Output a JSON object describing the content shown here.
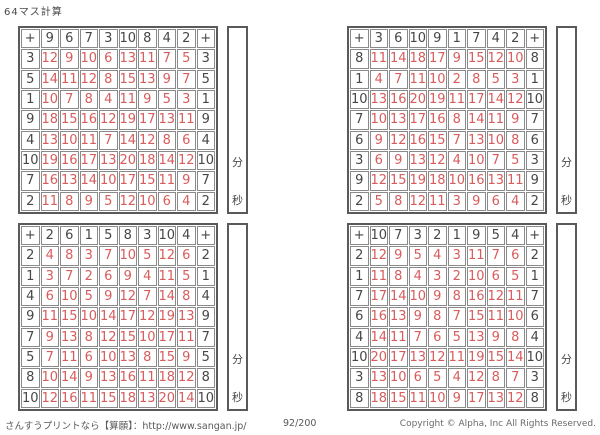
{
  "page": {
    "title": "64マス計算"
  },
  "labels": {
    "operator": "+",
    "minutes": "分",
    "seconds": "秒"
  },
  "colors": {
    "header_text": "#474747",
    "answer_text": "#d95c5c",
    "grid_line": "#8a8a8a",
    "grid_border": "#5a5a5a"
  },
  "grids": [
    {
      "position": "top-left",
      "top_headers": [
        9,
        6,
        7,
        3,
        10,
        8,
        4,
        2
      ],
      "rows": [
        {
          "header": 3,
          "answers": [
            12,
            9,
            10,
            6,
            13,
            11,
            7,
            5
          ]
        },
        {
          "header": 5,
          "answers": [
            14,
            11,
            12,
            8,
            15,
            13,
            9,
            7
          ]
        },
        {
          "header": 1,
          "answers": [
            10,
            7,
            8,
            4,
            11,
            9,
            5,
            3
          ]
        },
        {
          "header": 9,
          "answers": [
            18,
            15,
            16,
            12,
            19,
            17,
            13,
            11
          ]
        },
        {
          "header": 4,
          "answers": [
            13,
            10,
            11,
            7,
            14,
            12,
            8,
            6
          ]
        },
        {
          "header": 10,
          "answers": [
            19,
            16,
            17,
            13,
            20,
            18,
            14,
            12
          ]
        },
        {
          "header": 7,
          "answers": [
            16,
            13,
            14,
            10,
            17,
            15,
            11,
            9
          ]
        },
        {
          "header": 2,
          "answers": [
            11,
            8,
            9,
            5,
            12,
            10,
            6,
            4
          ]
        }
      ]
    },
    {
      "position": "top-right",
      "top_headers": [
        3,
        6,
        10,
        9,
        1,
        7,
        4,
        2
      ],
      "rows": [
        {
          "header": 8,
          "answers": [
            11,
            14,
            18,
            17,
            9,
            15,
            12,
            10
          ]
        },
        {
          "header": 1,
          "answers": [
            4,
            7,
            11,
            10,
            2,
            8,
            5,
            3
          ]
        },
        {
          "header": 10,
          "answers": [
            13,
            16,
            20,
            19,
            11,
            17,
            14,
            12
          ]
        },
        {
          "header": 7,
          "answers": [
            10,
            13,
            17,
            16,
            8,
            14,
            11,
            9
          ]
        },
        {
          "header": 6,
          "answers": [
            9,
            12,
            16,
            15,
            7,
            13,
            10,
            8
          ]
        },
        {
          "header": 3,
          "answers": [
            6,
            9,
            13,
            12,
            4,
            10,
            7,
            5
          ]
        },
        {
          "header": 9,
          "answers": [
            12,
            15,
            19,
            18,
            10,
            16,
            13,
            11
          ]
        },
        {
          "header": 2,
          "answers": [
            5,
            8,
            12,
            11,
            3,
            9,
            6,
            4
          ]
        }
      ]
    },
    {
      "position": "bottom-left",
      "top_headers": [
        2,
        6,
        1,
        5,
        8,
        3,
        10,
        4
      ],
      "rows": [
        {
          "header": 2,
          "answers": [
            4,
            8,
            3,
            7,
            10,
            5,
            12,
            6
          ]
        },
        {
          "header": 1,
          "answers": [
            3,
            7,
            2,
            6,
            9,
            4,
            11,
            5
          ]
        },
        {
          "header": 4,
          "answers": [
            6,
            10,
            5,
            9,
            12,
            7,
            14,
            8
          ]
        },
        {
          "header": 9,
          "answers": [
            11,
            15,
            10,
            14,
            17,
            12,
            19,
            13
          ]
        },
        {
          "header": 7,
          "answers": [
            9,
            13,
            8,
            12,
            15,
            10,
            17,
            11
          ]
        },
        {
          "header": 5,
          "answers": [
            7,
            11,
            6,
            10,
            13,
            8,
            15,
            9
          ]
        },
        {
          "header": 8,
          "answers": [
            10,
            14,
            9,
            13,
            16,
            11,
            18,
            12
          ]
        },
        {
          "header": 10,
          "answers": [
            12,
            16,
            11,
            15,
            18,
            13,
            20,
            14
          ]
        }
      ]
    },
    {
      "position": "bottom-right",
      "top_headers": [
        10,
        7,
        3,
        2,
        1,
        9,
        5,
        4
      ],
      "rows": [
        {
          "header": 2,
          "answers": [
            12,
            9,
            5,
            4,
            3,
            11,
            7,
            6
          ]
        },
        {
          "header": 1,
          "answers": [
            11,
            8,
            4,
            3,
            2,
            10,
            6,
            5
          ]
        },
        {
          "header": 7,
          "answers": [
            17,
            14,
            10,
            9,
            8,
            16,
            12,
            11
          ]
        },
        {
          "header": 6,
          "answers": [
            16,
            13,
            9,
            8,
            7,
            15,
            11,
            10
          ]
        },
        {
          "header": 4,
          "answers": [
            14,
            11,
            7,
            6,
            5,
            13,
            9,
            8
          ]
        },
        {
          "header": 10,
          "answers": [
            20,
            17,
            13,
            12,
            11,
            19,
            15,
            14
          ]
        },
        {
          "header": 3,
          "answers": [
            13,
            10,
            6,
            5,
            4,
            12,
            8,
            7
          ]
        },
        {
          "header": 8,
          "answers": [
            18,
            15,
            11,
            10,
            9,
            17,
            13,
            12
          ]
        }
      ]
    }
  ],
  "footer": {
    "left": "さんすうプリントなら【算願】：http://www.sangan.jp/",
    "page_indicator": "92/200",
    "copyright": "Copyright © Alpha, Inc All Rights Reserved."
  }
}
